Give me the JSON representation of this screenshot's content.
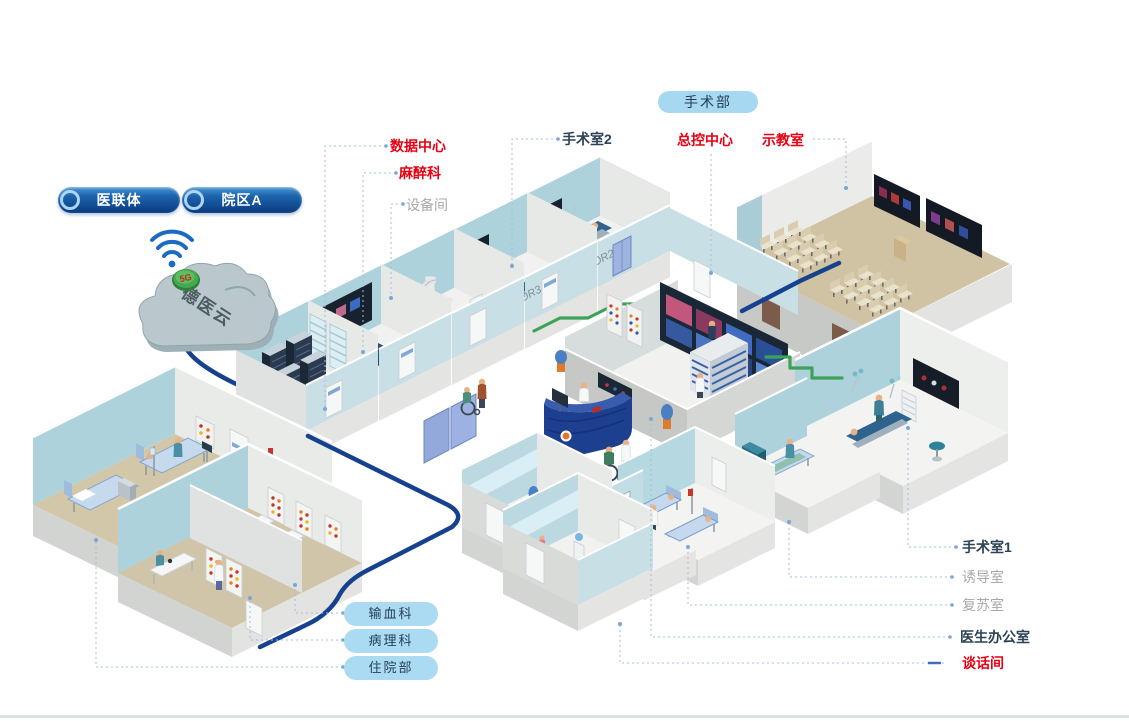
{
  "header": {
    "pills": [
      {
        "label": "医联体"
      },
      {
        "label": "院区A"
      }
    ]
  },
  "cloud": {
    "name": "德医云",
    "badge": "5G"
  },
  "department_pill": "手术部",
  "callouts": {
    "data_center": "数据中心",
    "anesthesiology": "麻醉科",
    "equipment_room": "设备间",
    "operating_room_2": "手术室2",
    "master_control_center": "总控中心",
    "demo_classroom": "示教室",
    "operating_room_1": "手术室1",
    "induction_room": "诱导室",
    "recovery_room": "复苏室",
    "doctors_office": "医生办公室",
    "interview_room": "谈话间"
  },
  "bottom_pills": [
    {
      "label": "输血科"
    },
    {
      "label": "病理科"
    },
    {
      "label": "住院部"
    }
  ],
  "room_tags": {
    "or2": "OR2",
    "or3": "OR3"
  },
  "colors": {
    "accent_red": "#e60012",
    "label_dark": "#2c4257",
    "label_gray": "#a9a9a9",
    "pill_light_blue": "#abdaf3",
    "pill_dark_blue": "#0b3a7e",
    "cable_blue": "#15418e",
    "cable_green": "#3da257",
    "wall_teal": "#aed2db",
    "floor_tan": "#cfc4a5"
  }
}
